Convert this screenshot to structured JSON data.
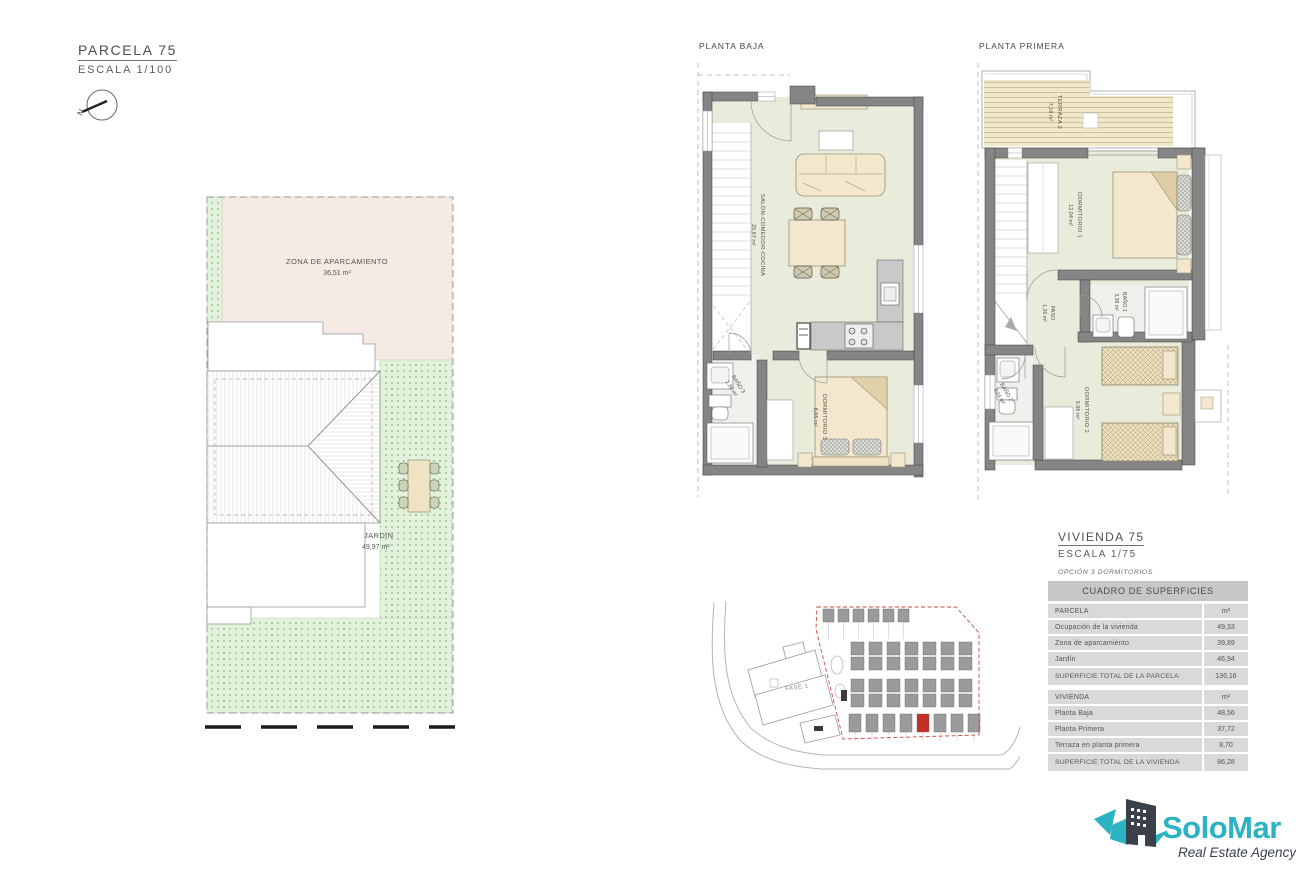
{
  "parcela_block": {
    "title": "PARCELA 75",
    "scale": "ESCALA 1/100",
    "north": "N"
  },
  "site_plan": {
    "parking_label": "ZONA DE APARCAMIENTO",
    "parking_area": "36,51 m²",
    "garden_label": "JARDIN",
    "garden_area": "49,97 m²"
  },
  "planta_baja": {
    "title": "PLANTA BAJA",
    "salon": {
      "name": "SALÓN-COMEDOR-COCINA",
      "area": "25,67 m²"
    },
    "bano3": {
      "name": "BAÑO 3",
      "area": "2,88 m²"
    },
    "dorm3": {
      "name": "DORMITORIO 3",
      "area": "8,65 m²"
    }
  },
  "planta_primera": {
    "title": "PLANTA PRIMERA",
    "terraza": {
      "name": "TERRAZA 2",
      "area": "7,18 m²"
    },
    "dorm1": {
      "name": "DORMITORIO 1",
      "area": "12,04 m²"
    },
    "bano1": {
      "name": "BAÑO 1",
      "area": "3,38 m²"
    },
    "paso": {
      "name": "PASO",
      "area": "1,26 m²"
    },
    "bano2": {
      "name": "BAÑO 2",
      "area": "3,24 m²"
    },
    "dorm2": {
      "name": "DORMITORIO 2",
      "area": "9,96 m²"
    }
  },
  "vivienda_block": {
    "title": "VIVIENDA 75",
    "scale": "ESCALA 1/75",
    "option": "OPCIÓN 3 DORMITORIOS"
  },
  "location_map": {
    "fase_label": "FASE 1"
  },
  "surfaces_table": {
    "title": "CUADRO DE SUPERFICIES",
    "parcela_header": "PARCELA",
    "parcela_unit": "m²",
    "rows_parcela": [
      {
        "label": "Ocupación de la vivienda",
        "value": "49,33"
      },
      {
        "label": "Zona de aparcamiento",
        "value": "39,89"
      },
      {
        "label": "Jardín",
        "value": "46,94"
      }
    ],
    "parcela_total_label": "SUPERFICIE TOTAL DE LA PARCELA",
    "parcela_total_value": "136,16",
    "vivienda_header": "VIVIENDA",
    "vivienda_unit": "m²",
    "rows_vivienda": [
      {
        "label": "Planta Baja",
        "value": "48,56"
      },
      {
        "label": "Planta Primera",
        "value": "37,72"
      },
      {
        "label": "Terraza en planta primera",
        "value": "8,70"
      }
    ],
    "vivienda_total_label": "SUPERFICIE TOTAL DE LA VIVIENDA",
    "vivienda_total_value": "86,28"
  },
  "logo": {
    "brand": "SoloMar",
    "tagline": "Real Estate Agency",
    "teal": "#2BB3C4",
    "dark": "#3A414B"
  }
}
